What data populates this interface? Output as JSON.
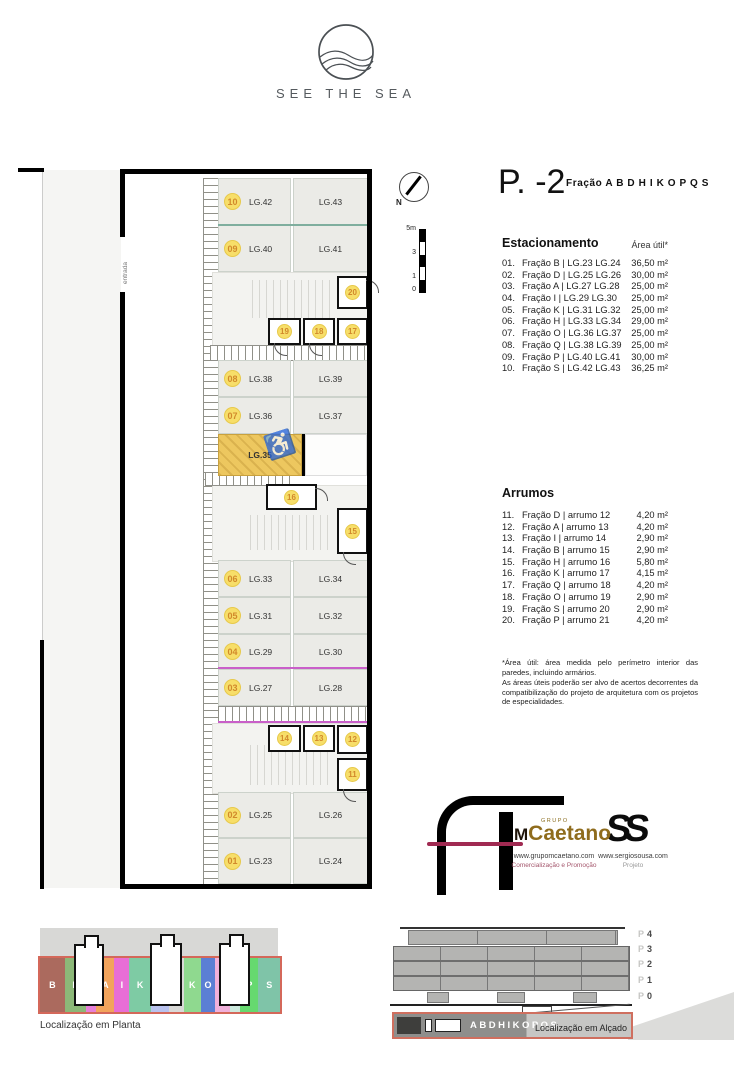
{
  "colors": {
    "badge_yellow": "#f7de69",
    "badge_text": "#d1892b",
    "accessible_yellow": "#edc75f",
    "magenta_line": "#c95fc9",
    "teal_line": "#7fae9e",
    "salmon_outline": "#d4685a",
    "caetano_gold": "#8f6c1d",
    "caetano_crimson": "#a02a52"
  },
  "brand": {
    "name": "SEE THE SEA"
  },
  "titleblock": {
    "level": "P. -2",
    "fraction": "Fração A B D H I K O P Q S"
  },
  "north": {
    "label": "N"
  },
  "scale": {
    "labels": [
      "5m",
      "3",
      "1",
      "0"
    ]
  },
  "parking_list": {
    "title": "Estacionamento",
    "area_header": "Área útil*",
    "rows": [
      {
        "num": "01.",
        "label": "Fração B | LG.23 LG.24",
        "area": "36,50 m²"
      },
      {
        "num": "02.",
        "label": "Fração D | LG.25 LG.26",
        "area": "30,00 m²"
      },
      {
        "num": "03.",
        "label": "Fração A | LG.27 LG.28",
        "area": "25,00 m²"
      },
      {
        "num": "04.",
        "label": "Fração I | LG.29 LG.30",
        "area": "25,00 m²"
      },
      {
        "num": "05.",
        "label": "Fração K | LG.31 LG.32",
        "area": "25,00 m²"
      },
      {
        "num": "06.",
        "label": "Fração H | LG.33 LG.34",
        "area": "29,00 m²"
      },
      {
        "num": "07.",
        "label": "Fração O | LG.36 LG.37",
        "area": "25,00 m²"
      },
      {
        "num": "08.",
        "label": "Fração Q | LG.38 LG.39",
        "area": "25,00 m²"
      },
      {
        "num": "09.",
        "label": "Fração P | LG.40 LG.41",
        "area": "30,00 m²"
      },
      {
        "num": "10.",
        "label": "Fração S | LG.42 LG.43",
        "area": "36,25 m²"
      }
    ]
  },
  "storage_list": {
    "title": "Arrumos",
    "rows": [
      {
        "num": "11.",
        "label": "Fração D | arrumo 12",
        "area": "4,20 m²"
      },
      {
        "num": "12.",
        "label": "Fração A | arrumo 13",
        "area": "4,20 m²"
      },
      {
        "num": "13.",
        "label": "Fração I | arrumo 14",
        "area": "2,90 m²"
      },
      {
        "num": "14.",
        "label": "Fração B | arrumo 15",
        "area": "2,90 m²"
      },
      {
        "num": "15.",
        "label": "Fração H | arrumo 16",
        "area": "5,80 m²"
      },
      {
        "num": "16.",
        "label": "Fração K | arrumo 17",
        "area": "4,15 m²"
      },
      {
        "num": "17.",
        "label": "Fração Q | arrumo 18",
        "area": "4,20 m²"
      },
      {
        "num": "18.",
        "label": "Fração O | arrumo 19",
        "area": "2,90 m²"
      },
      {
        "num": "19.",
        "label": "Fração S | arrumo 20",
        "area": "2,90 m²"
      },
      {
        "num": "20.",
        "label": "Fração P | arrumo 21",
        "area": "4,20 m²"
      }
    ]
  },
  "footnote": {
    "line1": "*Área útil: área medida pelo perímetro interior das paredes, incluindo armários.",
    "line2": "As áreas úteis poderão ser alvo de acertos decorrentes da compatibilização do projeto de arquitetura com os projetos de especialidades."
  },
  "plan": {
    "entrada": "entrada",
    "rows": [
      {
        "badge": "10",
        "left": "LG.42",
        "right": "LG.43"
      },
      {
        "badge": "09",
        "left": "LG.40",
        "right": "LG.41"
      },
      {
        "badge": "08",
        "left": "LG.38",
        "right": "LG.39"
      },
      {
        "badge": "07",
        "left": "LG.36",
        "right": "LG.37"
      },
      {
        "badge": "06",
        "left": "LG.33",
        "right": "LG.34"
      },
      {
        "badge": "05",
        "left": "LG.31",
        "right": "LG.32"
      },
      {
        "badge": "04",
        "left": "LG.29",
        "right": "LG.30"
      },
      {
        "badge": "03",
        "left": "LG.27",
        "right": "LG.28"
      },
      {
        "badge": "02",
        "left": "LG.25",
        "right": "LG.26"
      },
      {
        "badge": "01",
        "left": "LG.23",
        "right": "LG.24"
      }
    ],
    "accessible": {
      "label": "LG.35",
      "icon": "♿"
    },
    "storage": {
      "s20": "20",
      "s19": "19",
      "s18": "18",
      "s17": "17",
      "s16": "16",
      "s15": "15",
      "s14": "14",
      "s13": "13",
      "s12": "12",
      "s11": "11"
    }
  },
  "credits": {
    "caetano": {
      "grupo": "GRUPO",
      "m": "M",
      "name": "Caetano",
      "url": "www.grupomcaetano.com",
      "tagline": "Comercialização e Promoção"
    },
    "sousa": {
      "mark": "SS",
      "url": "www.sergiosousa.com",
      "tagline": "Projeto"
    }
  },
  "loc_planta": {
    "label": "Localização em Planta",
    "segments": [
      {
        "letter": "B",
        "color": "#ab6a5e"
      },
      {
        "letter": "D",
        "color": "#8cb878"
      },
      {
        "letter": "B\nI\nA",
        "color": "#e77fd8"
      },
      {
        "letter": "A",
        "color": "#f2a45c"
      },
      {
        "letter": "I",
        "color": "#e86ed6"
      },
      {
        "letter": "K",
        "color": "#7ecba4"
      },
      {
        "letter": "H",
        "color": "#b9c2ee"
      },
      {
        "letter": "",
        "color": "#d9d9d7"
      },
      {
        "letter": "K",
        "color": "#8fd98f"
      },
      {
        "letter": "O",
        "color": "#5b7fd4"
      },
      {
        "letter": "Q",
        "color": "#f0b0da"
      },
      {
        "letter": "S\nO\nQ",
        "color": "#cdeade"
      },
      {
        "letter": "P",
        "color": "#66d96f"
      },
      {
        "letter": "S",
        "color": "#7fc4a8"
      }
    ]
  },
  "loc_alcado": {
    "label": "Localização em Alçado",
    "strip": "ABDHIKOPQS",
    "floors": [
      {
        "p": "P",
        "n": "4"
      },
      {
        "p": "P",
        "n": "3"
      },
      {
        "p": "P",
        "n": "2"
      },
      {
        "p": "P",
        "n": "1"
      },
      {
        "p": "P",
        "n": "0"
      }
    ]
  }
}
